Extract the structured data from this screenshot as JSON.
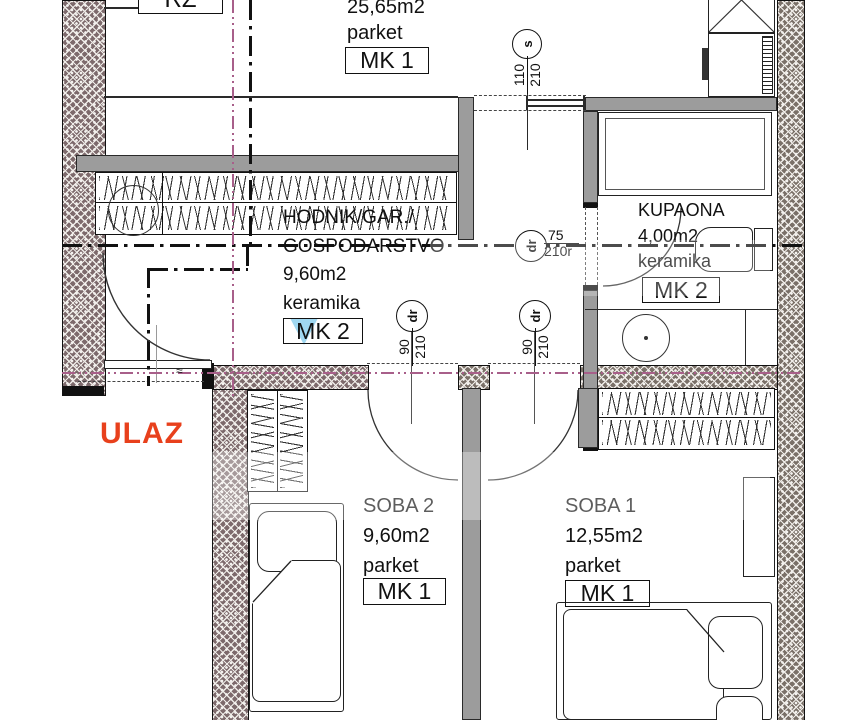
{
  "plan": {
    "top_room": {
      "area": "25,65m2",
      "floor": "parket",
      "mk": "MK 1"
    },
    "hodnik": {
      "name1": "HODNIK/GAR./",
      "name2": "GOSPODARSTVO",
      "area": "9,60m2",
      "floor": "keramika",
      "mk": "MK 2"
    },
    "kupaona": {
      "name": "KUPAONA",
      "area": "4,00m2",
      "floor": "keramika",
      "mk": "MK 2"
    },
    "soba2": {
      "name": "SOBA 2",
      "area": "9,60m2",
      "floor": "parket",
      "mk": "MK 1"
    },
    "soba1": {
      "name": "SOBA 1",
      "area": "12,55m2",
      "floor": "parket",
      "mk": "MK 1"
    },
    "entrance_label": "ULAZ",
    "rz_label": "RZ",
    "entrance_mark": "≈",
    "doors": {
      "window_s": {
        "tag": "s",
        "w": "110",
        "h": "210"
      },
      "bath": {
        "tag": "dr",
        "w": "75",
        "h": "210r"
      },
      "soba2": {
        "tag": "dr",
        "w": "90",
        "h": "210"
      },
      "soba1": {
        "tag": "dr",
        "w": "90",
        "h": "210"
      }
    },
    "colors": {
      "entrance_red": "#e8401c",
      "centerline_magenta": "#a85f8a",
      "wall_gray": "#9c9c9c"
    }
  }
}
